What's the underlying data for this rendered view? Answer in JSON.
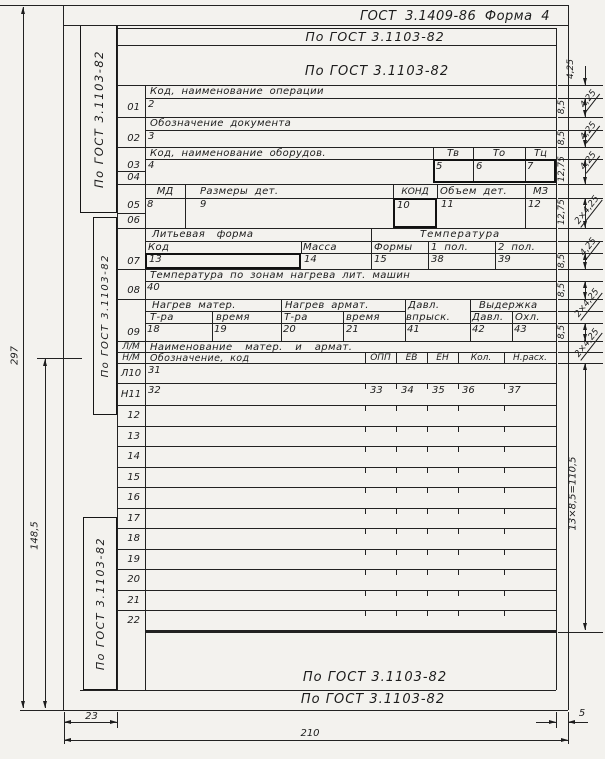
{
  "meta": {
    "title": "ГОСТ 3.1409-86  Форма 4"
  },
  "gost_strips": {
    "top1": "По ГОСТ 3.1103-82",
    "top2": "По ГОСТ 3.1103-82",
    "bottom1": "По ГОСТ 3.1103-82",
    "bottom2": "По ГОСТ 3.1103-82",
    "side1": "По ГОСТ 3.1103-82",
    "side2": "По ГОСТ 3.1103-82",
    "side3": "По ГОСТ 3.1103-82"
  },
  "form": {
    "s1": {
      "no": "01",
      "header": "Код, наименование операции",
      "value": "2"
    },
    "s2": {
      "no": "02",
      "header": "Обозначение документа",
      "value": "3"
    },
    "s3": {
      "no1": "03",
      "no2": "04",
      "header": "Код, наименование оборудов.",
      "c1": "Тв",
      "c2": "То",
      "c3": "Тц",
      "v1": "4",
      "v2": "5",
      "v3": "6",
      "v4": "7"
    },
    "s4": {
      "no1": "05",
      "no2": "06",
      "c1": "МД",
      "c2": "Размеры дет.",
      "c3": "КОНД",
      "c4": "Объем дет.",
      "c5": "МЗ",
      "v1": "8",
      "v2": "9",
      "v3": "10",
      "v4": "11",
      "v5": "12"
    },
    "s5": {
      "no": "07",
      "g1": "Литьевая форма",
      "g2": "Температура",
      "c1": "Код",
      "c2": "Масса",
      "c3": "Формы",
      "c4": "1 пол.",
      "c5": "2 пол.",
      "v1": "13",
      "v2": "14",
      "v3": "15",
      "v4": "38",
      "v5": "39"
    },
    "s6": {
      "no": "08",
      "header": "Температура по зонам нагрева лит. машин",
      "value": "40"
    },
    "s7": {
      "no": "09",
      "g1": "Нагрев матер.",
      "g2": "Нагрев армат.",
      "g3": "Давл.",
      "g3b": "впрыск.",
      "g4": "Выдержка",
      "c1": "Т-ра",
      "c2": "время",
      "c3": "Т-ра",
      "c4": "время",
      "c5": "Давл.",
      "c6": "Охл.",
      "v1": "18",
      "v2": "19",
      "v3": "20",
      "v4": "21",
      "v5": "41",
      "v6": "42",
      "v7": "43"
    },
    "s8": {
      "no": "Л/М",
      "header": "Наименование матер. и армат."
    },
    "s9": {
      "no": "Н/М",
      "header": "Обозначение, код",
      "c1": "ОПП",
      "c2": "ЕВ",
      "c3": "ЕН",
      "c4": "Кол.",
      "c5": "Н.расх."
    },
    "r10": {
      "no": "Л10",
      "value": "31"
    },
    "r11": {
      "no": "Н11",
      "value": "32",
      "v1": "33",
      "v2": "34",
      "v3": "35",
      "v4": "36",
      "v5": "37"
    },
    "empty_rows": [
      "12",
      "13",
      "14",
      "15",
      "16",
      "17",
      "18",
      "19",
      "20",
      "21",
      "22"
    ]
  },
  "dims": {
    "paper_height": "297",
    "half_height": "148,5",
    "left_margin": "23",
    "paper_width": "210",
    "right_margin": "5",
    "row_block": "13×8,5=110,5",
    "chain": [
      {
        "v": "4,25",
        "d": ""
      },
      {
        "v": "8,5",
        "d": "4,25"
      },
      {
        "v": "8,5",
        "d": "4,25"
      },
      {
        "v": "12,75",
        "d": "4,25"
      },
      {
        "v": "12,75",
        "d": "2×4,25"
      },
      {
        "v": "8,5",
        "d": "4,25"
      },
      {
        "v": "8,5",
        "d": "2×4,25"
      },
      {
        "v": "8,5",
        "d": "2×4,25"
      }
    ]
  }
}
